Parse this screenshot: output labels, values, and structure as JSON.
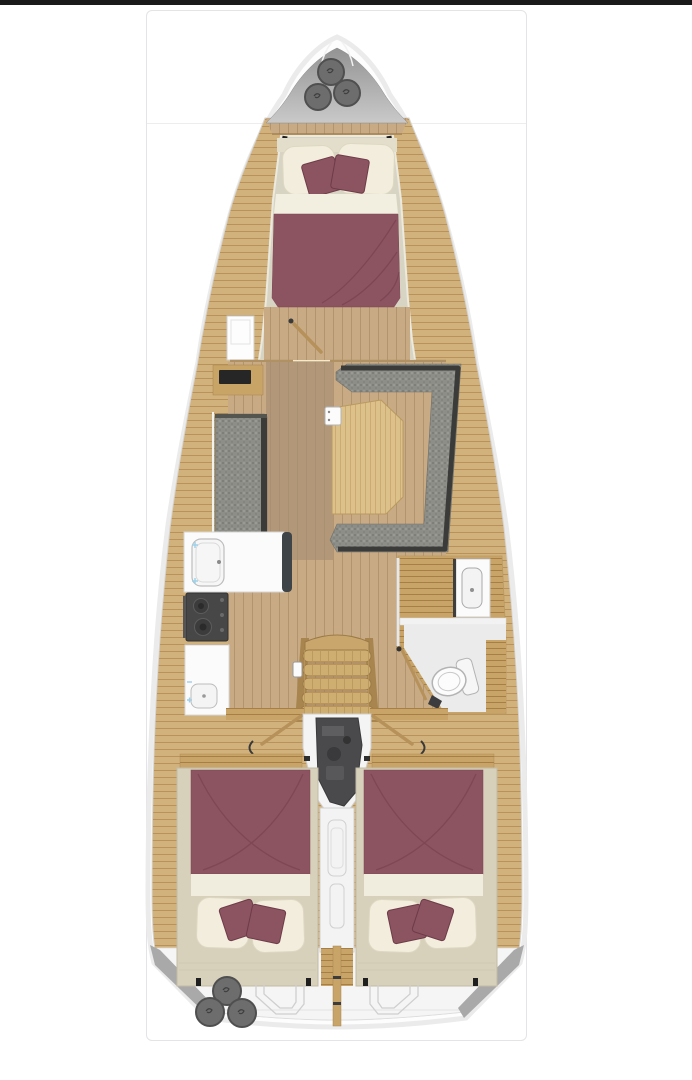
{
  "figure": {
    "name": "sailing-yacht-interior-floor-plan",
    "orientation": "bow-up",
    "layout": "3-cabin-1-head"
  },
  "parts": [
    "hull",
    "bow-locker",
    "bow-fenders",
    "foredeck-step",
    "forward-cabin",
    "forward-berth",
    "forward-cabin-door",
    "saloon",
    "port-cabinet",
    "port-settee",
    "dinette-sofa",
    "saloon-table",
    "galley",
    "galley-sink",
    "galley-stove",
    "galley-counter",
    "wet-head",
    "head-vanity",
    "toilet",
    "companionway-stairs",
    "engine-compartment",
    "aft-corridor",
    "aft-cabin-port",
    "aft-cabin-starboard",
    "aft-berth-port",
    "aft-berth-starboard",
    "stern-deck",
    "stern-lockers",
    "stern-fenders"
  ],
  "palette": {
    "background": "#ffffff",
    "top_bar": "#1a1a1a",
    "frame_border": "#e4e4e7",
    "divider": "#ededed",
    "hull_white": "#fdfdfd",
    "hull_outline": "#c7c7c7",
    "hull_inner_line": "#d6d6d6",
    "bow_gray_top": "#939393",
    "bow_gray_bottom": "#c9c9c9",
    "fender": "#6d6d6d",
    "fender_ring": "#4f4f4f",
    "wood_base": "#d2b27c",
    "wood_line": "#b8925a",
    "wood_floor": "#c8ab85",
    "wood_floor_line": "#b2946f",
    "wood_bright": "#dcc18b",
    "wood_dark": "#c9a468",
    "wood_dark_line": "#a67f47",
    "floor_brown": "#b29878",
    "cream_floor": "#d8d4c4",
    "maroon": "#8c5460",
    "maroon_dark": "#7a4350",
    "pillow": "#f2eddc",
    "pillow_edge": "#ded8c2",
    "sofa_gray": "#8e8e88",
    "sofa_speckle": "#7f7f79",
    "sofa_trim": "#3b3b39",
    "white_fixture": "#fbfbfb",
    "fixture_line": "#bdbdbd",
    "stove": "#474747",
    "engine": "#4a4a4c",
    "aisle_white": "#f3f3f3",
    "aisle_line": "#d0d0d0",
    "platform": "#d7d0bb",
    "platform_edge": "#c2bba6",
    "faucet_blue": "#9fd0e8",
    "wedge_gray": "#a9a9a9"
  }
}
